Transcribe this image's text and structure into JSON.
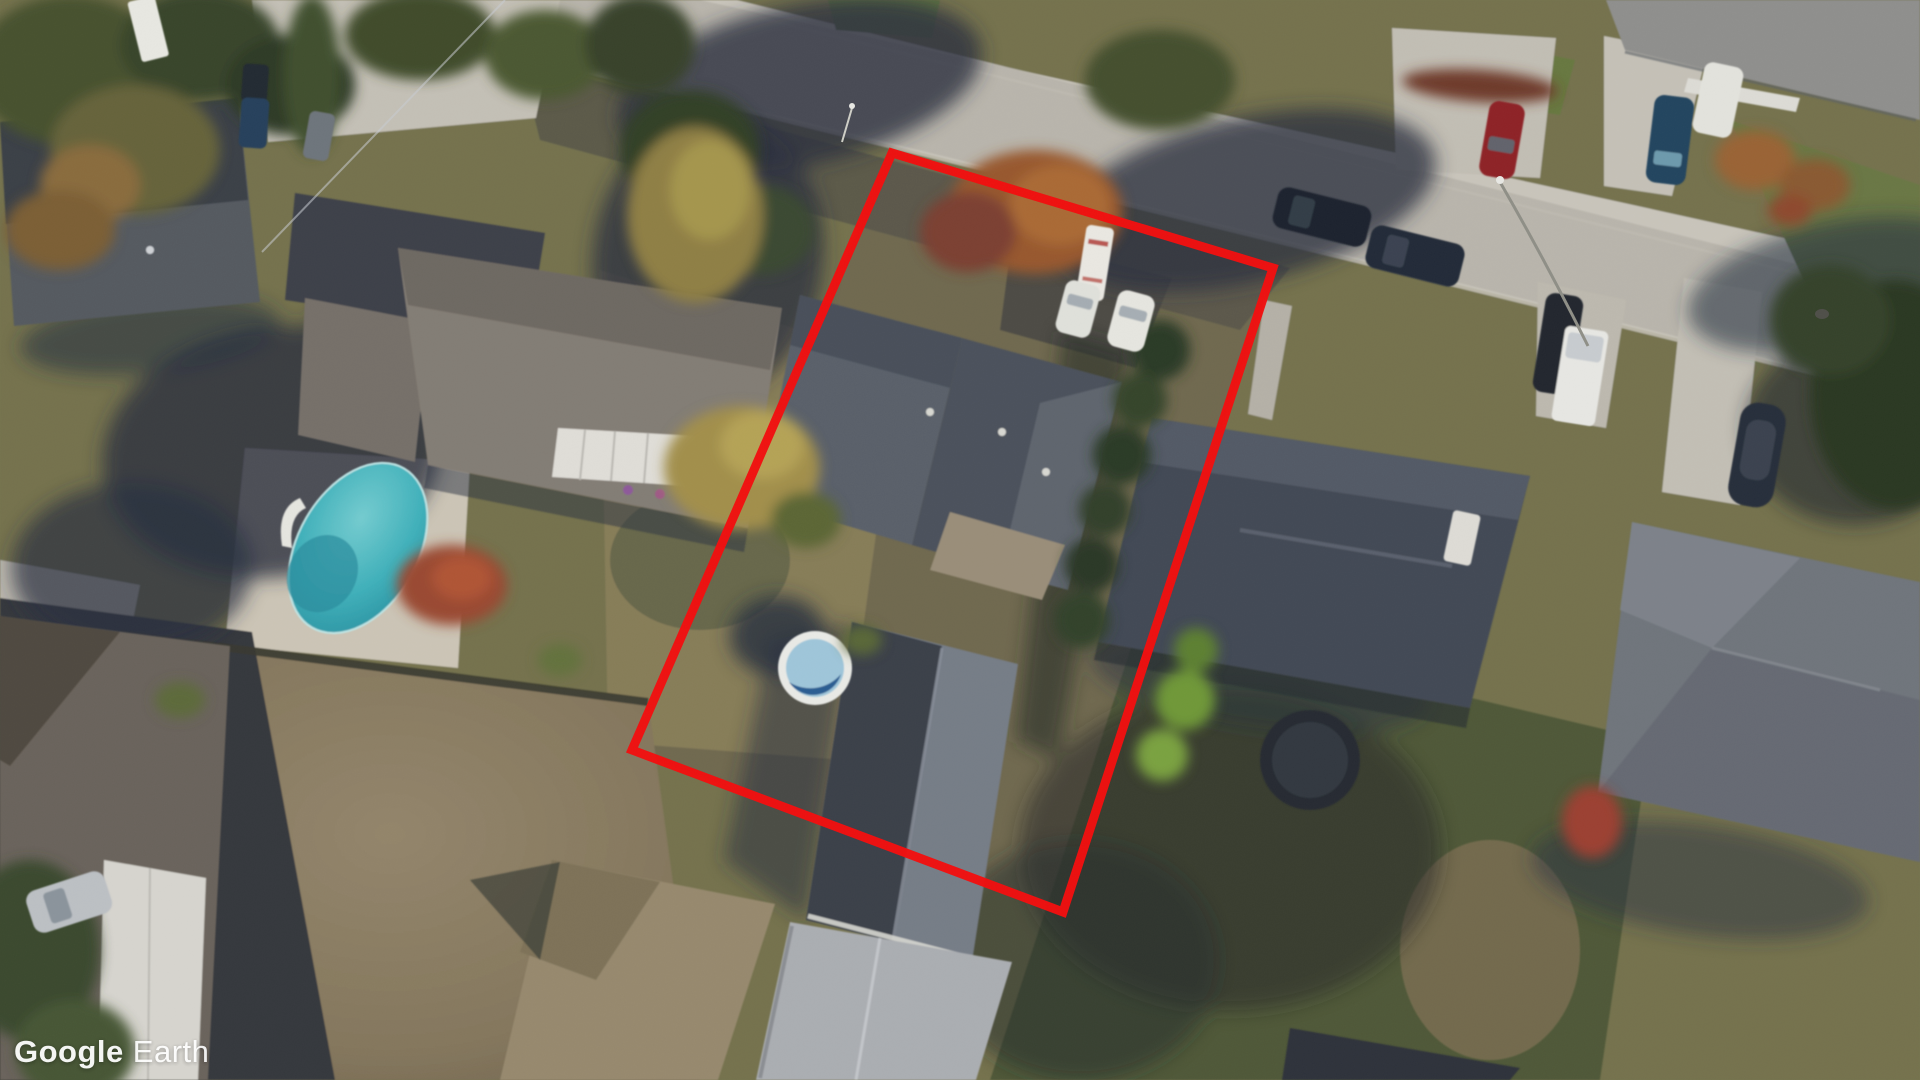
{
  "app": {
    "name": "Google Earth",
    "view_type": "oblique aerial satellite imagery"
  },
  "watermark": {
    "brand": "Google",
    "product": "Earth",
    "text_color": "#ffffff"
  },
  "overlay": {
    "property_outline": {
      "shape": "quadrilateral",
      "points": "892,153 1273,268 1063,912 632,750",
      "color": "#f20d0d",
      "stroke_width": 9,
      "purpose": "red boundary highlighting one residential parcel"
    }
  },
  "scene": {
    "season": "autumn",
    "description": "Suburban residential block seen from above; a street crosses the top diagonally, houses with dark shingle roofs, autumn trees, two pools, parked vehicles; one lot is outlined in red.",
    "ground_colors": {
      "road": "#b9b5ac",
      "sidewalk": "#c9c5bb",
      "concrete_driveway": "#c5c1b7",
      "dry_lawn": "#877d58",
      "green_lawn": "#5f7340",
      "dirt_field": "#8e8066",
      "tree_shadow": "#2a3140"
    },
    "features": [
      {
        "name": "street",
        "type": "road",
        "position": "runs diagonally from top-left down to the right edge"
      },
      {
        "name": "highlighted-property",
        "type": "parcel",
        "contents": [
          "gray two-section roof house",
          "long backyard workshop",
          "round above-ground pool",
          "parked RV and two white cars",
          "orange maple tree",
          "hedgerow on east boundary"
        ]
      },
      {
        "name": "oval-swimming-pool",
        "type": "pool",
        "water_color": "#3fb0ba",
        "deck_color": "#ccc5b6",
        "position": "left neighbor backyard with white slide"
      },
      {
        "name": "round-pool",
        "type": "pool",
        "rim_color": "#e9eae6",
        "water_colors": [
          "#9fc6da",
          "#2a5d92"
        ],
        "position": "inside highlighted parcel"
      },
      {
        "name": "trampoline",
        "type": "yard-item",
        "color": "#272c33",
        "position": "right-hand backyard"
      },
      {
        "name": "dirt-field",
        "type": "bare-ground",
        "position": "bottom left quarter"
      },
      {
        "name": "house-top-left",
        "roof_color": "#555a61"
      },
      {
        "name": "house-left-neighbor",
        "roof_color": "#837d75",
        "detail": "white patio awning"
      },
      {
        "name": "house-center-highlighted",
        "roof_color": "#4b515c"
      },
      {
        "name": "workshop-highlighted",
        "roof_colors": [
          "#3a4048",
          "#767d87"
        ]
      },
      {
        "name": "house-right-neighbor",
        "roof_color": "#434954"
      },
      {
        "name": "house-far-right",
        "roof_color": "#70757c"
      },
      {
        "name": "house-top-right",
        "roof_color": "#8f8f8d",
        "detail": "white porch trim"
      },
      {
        "name": "house-bottom-left",
        "roof_color": "#6b645b",
        "detail": "white garage roof"
      },
      {
        "name": "house-bottom-center",
        "roof_color": "#97896e"
      },
      {
        "name": "shed-bottom-center",
        "roof_color": "#abaeb2"
      }
    ],
    "vehicles": [
      {
        "name": "rv-trailer",
        "color": "#eae8e2",
        "position": "top of highlighted parcel"
      },
      {
        "name": "white-car-1",
        "color": "#e0e1db",
        "position": "parking pad of highlighted parcel"
      },
      {
        "name": "white-car-2",
        "color": "#e6e6e0",
        "position": "parking pad of highlighted parcel"
      },
      {
        "name": "dark-suv-on-street-1",
        "color": "#1d242e"
      },
      {
        "name": "dark-suv-on-street-2",
        "color": "#232b37"
      },
      {
        "name": "dark-suv-driveway",
        "color": "#20272f"
      },
      {
        "name": "white-pickup",
        "color": "#e7e7e3"
      },
      {
        "name": "red-car",
        "color": "#8e2126",
        "position": "driveway across the street"
      },
      {
        "name": "blue-car",
        "color": "#24445f",
        "position": "top-right driveway"
      },
      {
        "name": "white-car-top-right",
        "color": "#e3e3dd"
      },
      {
        "name": "boat-on-trailer",
        "color": "#272e3a",
        "position": "right-side concrete strip"
      },
      {
        "name": "white-camper",
        "color": "#dedcd6",
        "position": "beside right neighbor house"
      },
      {
        "name": "silver-car-bottom-left",
        "color": "#bcc0c4"
      },
      {
        "name": "dark-van-top-left",
        "color": "#232930"
      },
      {
        "name": "blue-car-top-left",
        "color": "#27405c"
      },
      {
        "name": "gray-car-top-left",
        "color": "#6e747c"
      },
      {
        "name": "white-trailer-top-left",
        "color": "#e8e8e2"
      }
    ],
    "street_furniture": [
      {
        "name": "street-lamp",
        "position": "arcs over street near right"
      },
      {
        "name": "storm-drain",
        "position": "right side of street"
      },
      {
        "name": "power-line",
        "position": "thin light line across top-left trees"
      }
    ]
  }
}
